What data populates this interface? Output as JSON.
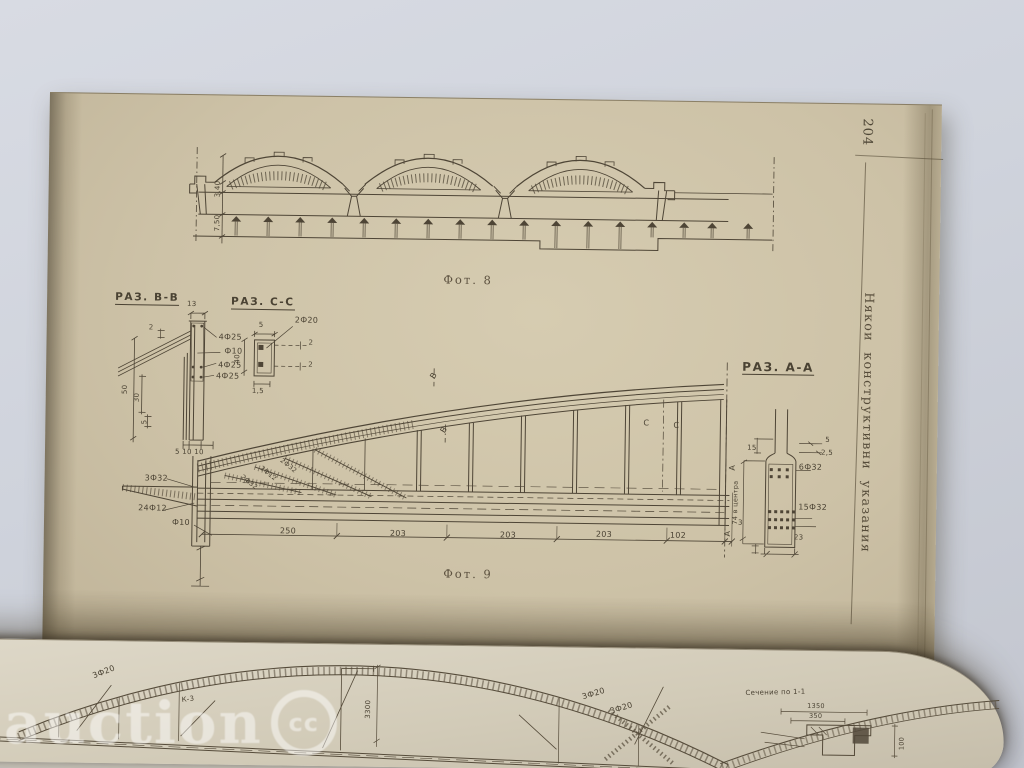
{
  "book": {
    "watermark": {
      "text": "auction",
      "badge_text": "cc"
    },
    "page_upper": {
      "page_number": "204",
      "margin_caption": "Някои конструктивни указания",
      "fig8": {
        "caption": "Фот. 8",
        "dim_340": "3,40",
        "dim_750": "7,50"
      },
      "section_bb": {
        "title": "РАЗ. В-В",
        "dim_13": "13",
        "dim_2": "2",
        "bars_4f25": "4Ф25",
        "bars_f10": "Ф10",
        "dim_50": "50",
        "dim_30": "30",
        "dim_5": "5",
        "dim_bottom": "5 10 10"
      },
      "section_cc": {
        "title": "РАЗ. С-С",
        "dim_5": "5",
        "bars_2f20": "2Ф20",
        "dim_2": "2",
        "dim_40": "40",
        "dim_15": "1,5"
      },
      "fig9": {
        "caption": "Фот. 9",
        "bars_3f32": "3Ф32",
        "bars_24f12": "24Ф12",
        "bars_f10": "Ф10",
        "diag_2f32": "2Ф32",
        "diag_2f12": "2Ф12",
        "marker_b": "В",
        "marker_c": "С",
        "marker_a": "А",
        "dim_250": "250",
        "dim_203": "203",
        "dim_102": "102"
      },
      "section_aa": {
        "title": "РАЗ. А-А",
        "dim_15": "15",
        "dim_5": "5",
        "dim_25": "2,5",
        "bars_6f32": "6Ф32",
        "bars_15f32": "15Ф32",
        "dim_74": "74 в центра",
        "dim_3": "3",
        "dim_23": "23"
      }
    },
    "page_lower": {
      "label_3f20": "3Ф20",
      "label_k3": "К-3",
      "dim_3300": "3300",
      "detail_title": "Сечение по 1-1",
      "dim_1350": "1350",
      "dim_350": "350",
      "dim_100": "100"
    }
  }
}
